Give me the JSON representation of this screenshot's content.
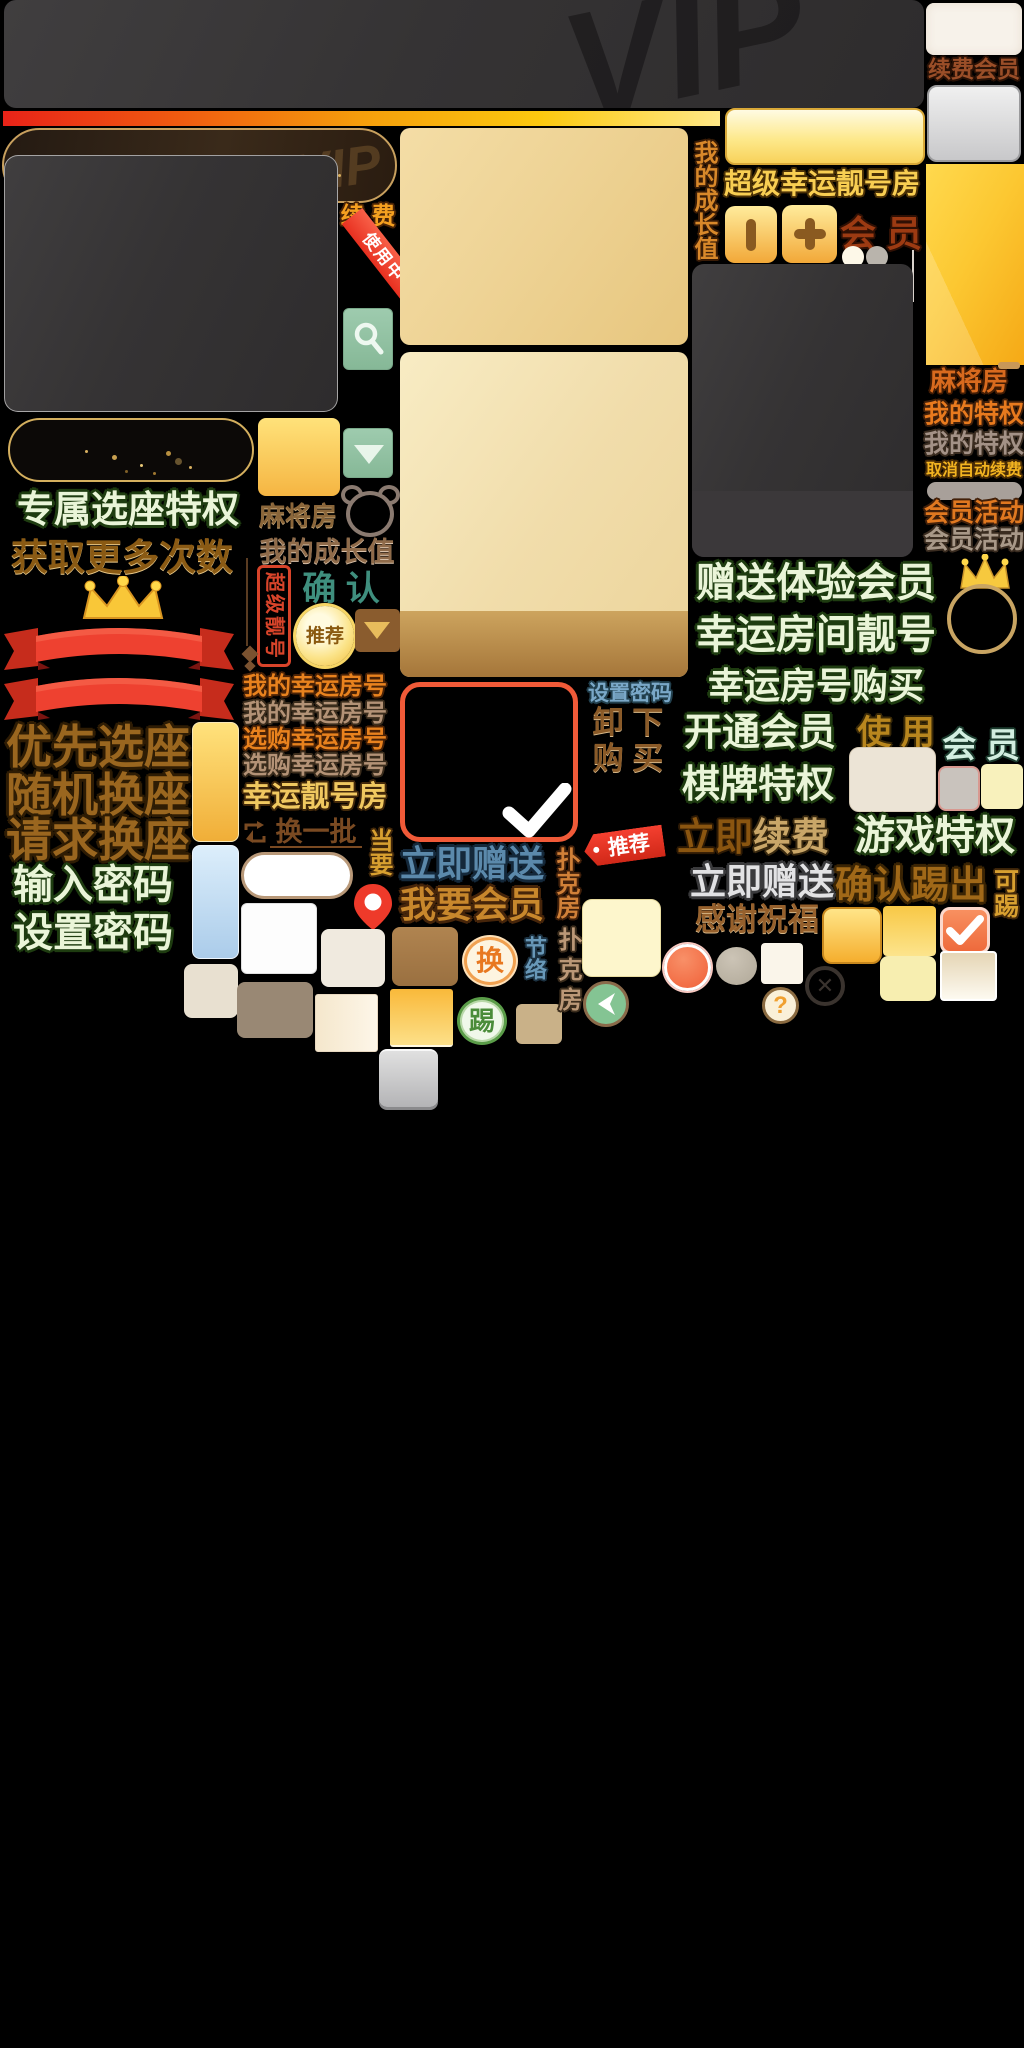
{
  "labels": {
    "vip": "VIP",
    "renew_member": "续费会员",
    "renew_spaced": "续 费",
    "in_use": "使用中",
    "my_growth": "我的成长值",
    "super_lucky_room": "超级幸运靓号房",
    "member_spaced": "会 员",
    "mahjong_room": "麻将房",
    "my_privilege": "我的特权",
    "cancel_auto_renew": "取消自动续费",
    "member_activity": "会员活动",
    "exclusive_seat_privilege": "专属选座特权",
    "get_more_times": "获取更多次数",
    "confirm_spaced": "确 认",
    "super_nice_number": "超级靓号",
    "recommend": "推荐",
    "priority_seat": "优先选座",
    "random_seat": "随机换座",
    "request_seat": "请求换座",
    "enter_password": "输入密码",
    "set_password": "设置密码",
    "my_lucky_room": "我的幸运房号",
    "buy_lucky_room": "选购幸运房号",
    "lucky_nice_room": "幸运靓号房",
    "change_batch": "换一批",
    "dang_yao": "当要",
    "give_now": "立即赠送",
    "want_member": "我要会员",
    "gift_trial_member": "赠送体验会员",
    "lucky_room_number": "幸运房间靓号",
    "lucky_number_buy": "幸运房号购买",
    "unload_spaced": "卸 下",
    "buy_spaced": "购 买",
    "open_member": "开通会员",
    "use_spaced": "使 用",
    "chess_privilege": "棋牌特权",
    "renew_now_a": "立即",
    "renew_now_b": "续费",
    "game_privilege": "游戏特权",
    "confirm_kick": "确认踢出",
    "kickable": "可踢",
    "thanks_blessing": "感谢祝福",
    "poker_room": "扑克房",
    "jie_luo": "节络",
    "swap": "换",
    "kick": "踢",
    "question_mark": "?",
    "close": "✕"
  },
  "colors": {
    "gold_accent": "#f5b93c",
    "red_accent": "#e8392b",
    "green_button": "#8fc0a0",
    "light_green_text": "#eaf5d8",
    "dark_panel": "#343233",
    "pale_gold_panel": "#efd79e"
  }
}
